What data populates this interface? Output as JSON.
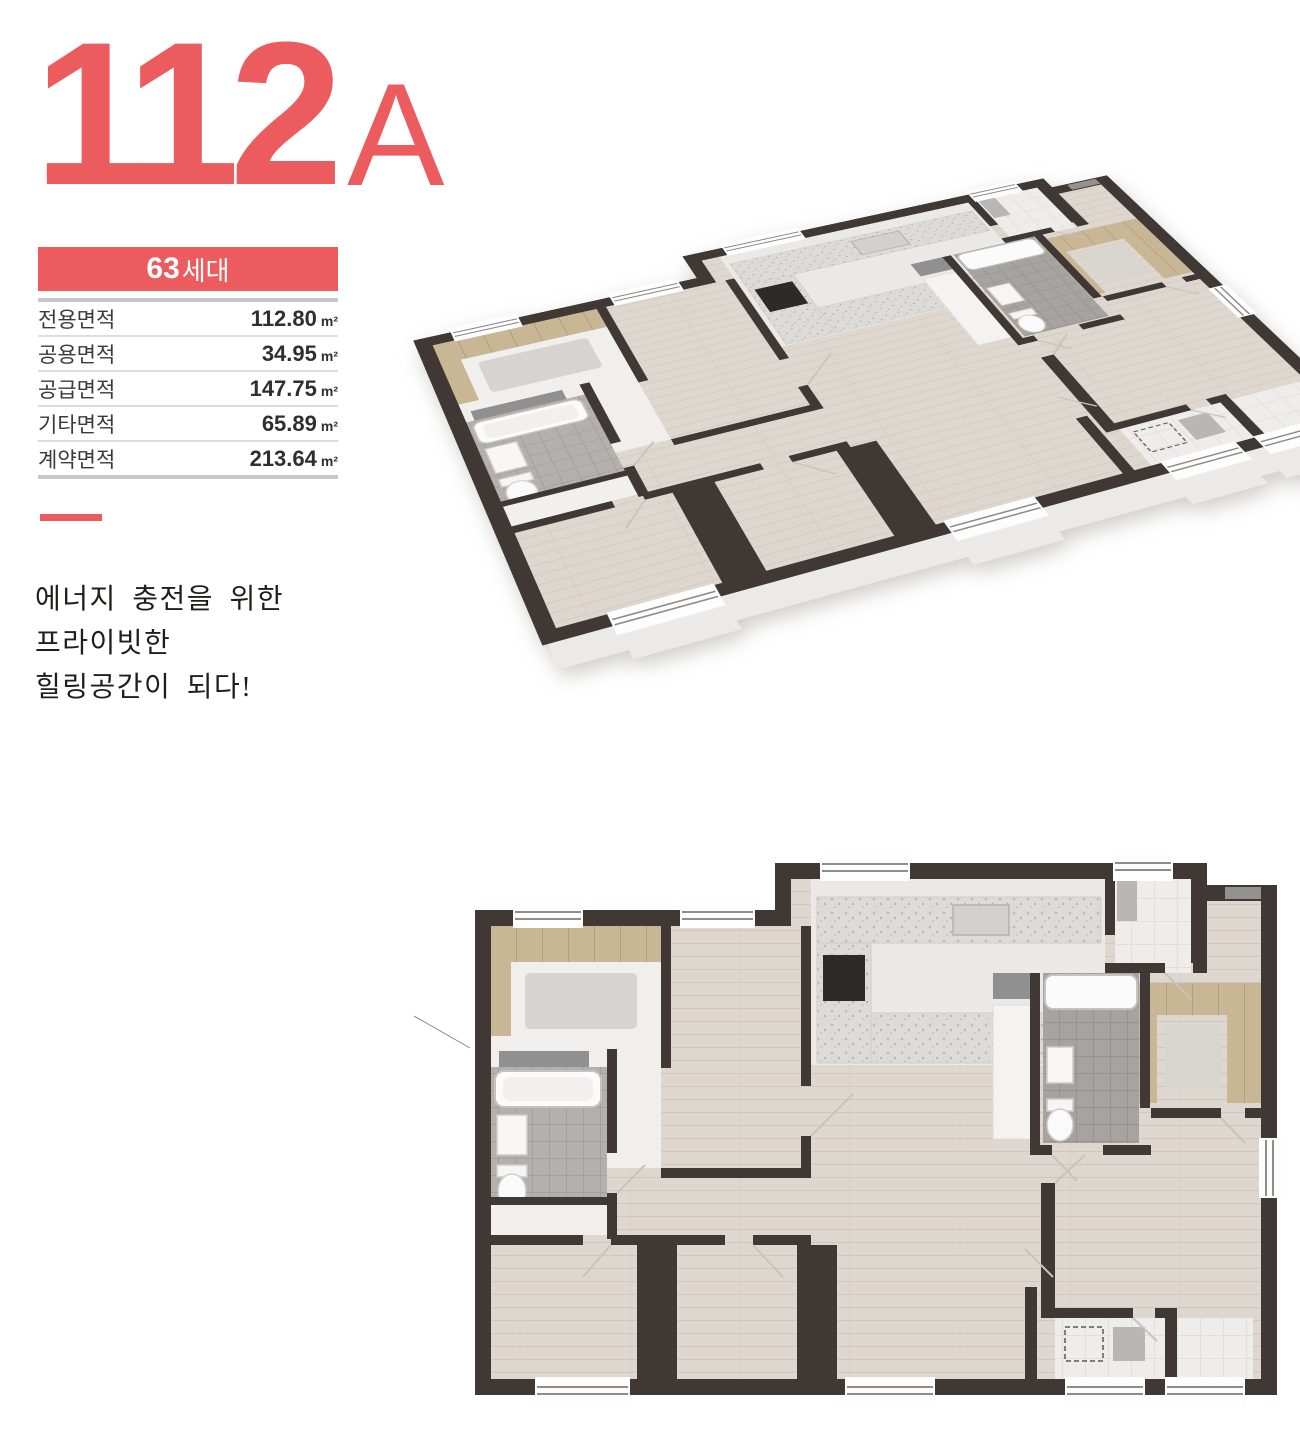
{
  "unit_badge": {
    "number": "112",
    "type_letter": "A"
  },
  "summary_table": {
    "header": {
      "count": "63",
      "count_suffix": "세대"
    },
    "rows": [
      {
        "label": "전용면적",
        "value": "112.80",
        "unit": "m²"
      },
      {
        "label": "공용면적",
        "value": "34.95",
        "unit": "m²"
      },
      {
        "label": "공급면적",
        "value": "147.75",
        "unit": "m²"
      },
      {
        "label": "기타면적",
        "value": "65.89",
        "unit": "m²"
      },
      {
        "label": "계약면적",
        "value": "213.64",
        "unit": "m²"
      }
    ]
  },
  "tagline": {
    "line1": "에너지 충전을 위한",
    "line2": "프라이빗한",
    "line3": "힐링공간이 되다!"
  },
  "colors": {
    "accent": "#ec5c5f",
    "wall": "#3f3834",
    "floor": "#ded7d0",
    "bath_tile": "#b0adaa",
    "wood": "#c9b694",
    "entry_tile": "#eeedeb",
    "frosted_glass": "#919090"
  }
}
